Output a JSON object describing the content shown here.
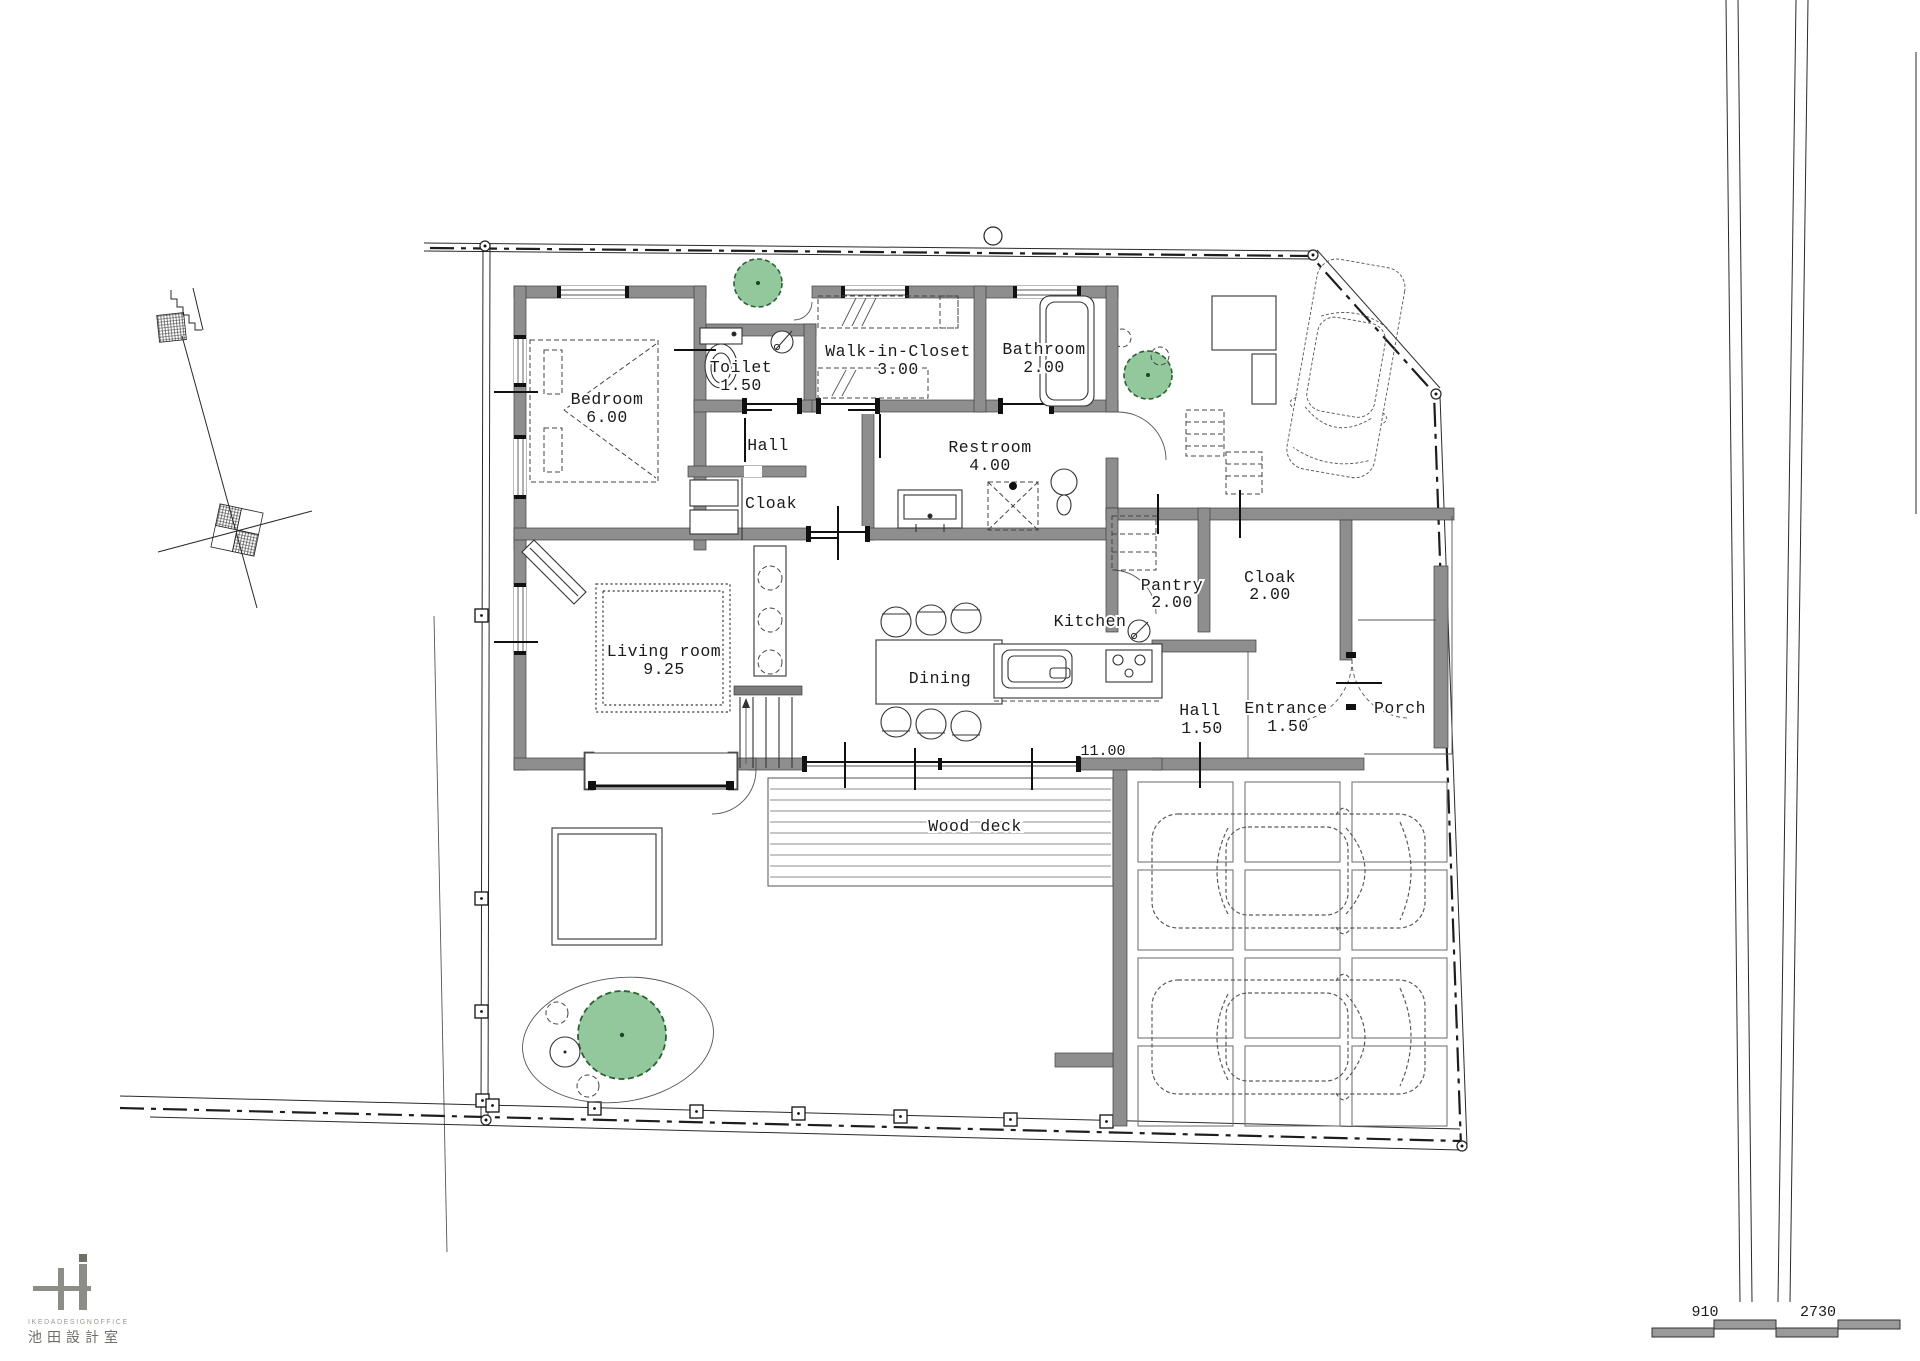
{
  "rooms": [
    {
      "name": "bedroom",
      "label": "Bedroom",
      "value": "6.00"
    },
    {
      "name": "toilet",
      "label": "Toilet",
      "value": "1.50"
    },
    {
      "name": "walk-in-closet",
      "label": "Walk-in-Closet",
      "value": "3.00"
    },
    {
      "name": "bathroom",
      "label": "Bathroom",
      "value": "2.00"
    },
    {
      "name": "hall-west",
      "label": "Hall",
      "value": ""
    },
    {
      "name": "cloak-west",
      "label": "Cloak",
      "value": ""
    },
    {
      "name": "restroom",
      "label": "Restroom",
      "value": "4.00"
    },
    {
      "name": "living-room",
      "label": "Living room",
      "value": "9.25"
    },
    {
      "name": "dining",
      "label": "Dining",
      "value": ""
    },
    {
      "name": "kitchen",
      "label": "Kitchen",
      "value": ""
    },
    {
      "name": "pantry",
      "label": "Pantry",
      "value": "2.00"
    },
    {
      "name": "cloak-entrance",
      "label": "Cloak",
      "value": "2.00"
    },
    {
      "name": "hall-entrance",
      "label": "Hall",
      "value": "1.50"
    },
    {
      "name": "entrance",
      "label": "Entrance",
      "value": "1.50"
    },
    {
      "name": "porch",
      "label": "Porch",
      "value": ""
    },
    {
      "name": "wood-deck",
      "label": "Wood deck",
      "value": ""
    }
  ],
  "dimensions": {
    "opening_width": "11.00",
    "scale_segment_left": "910",
    "scale_segment_right": "2730"
  },
  "branding": {
    "office_en": "IKEDADESIGNOFFICE",
    "office_jp": "池田設計室"
  },
  "colors": {
    "wall": "#8e8e8e",
    "tree_fill": "#93c89c",
    "tree_stroke": "#2d6135",
    "paper": "#ffffff"
  }
}
